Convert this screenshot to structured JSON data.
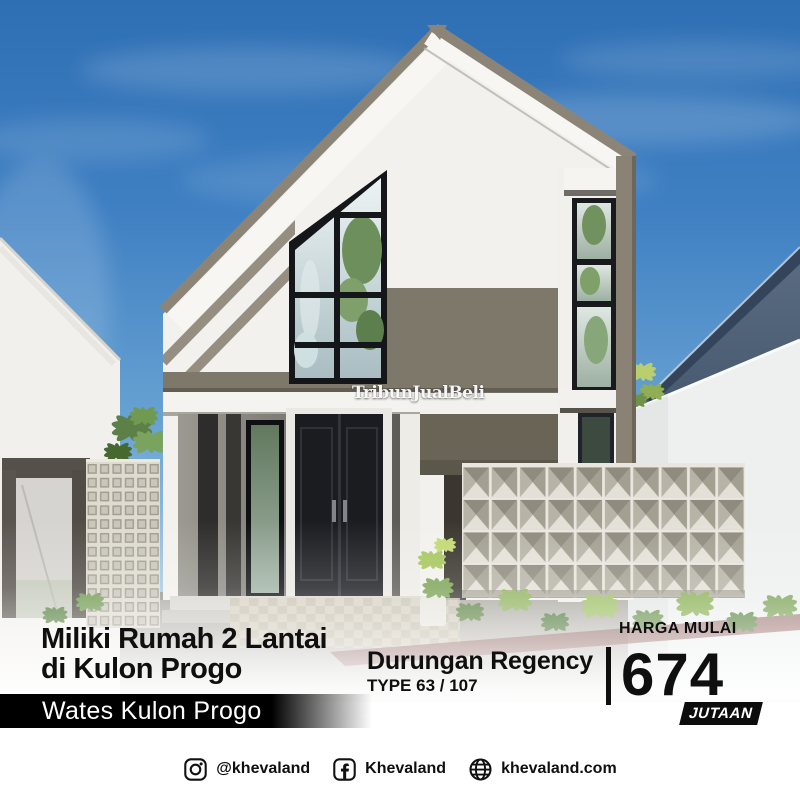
{
  "watermark": {
    "text": "TribunJualBeli"
  },
  "headline": {
    "line1": "Miliki Rumah 2 Lantai",
    "line2": "di Kulon Progo"
  },
  "location_banner": {
    "text": "Wates Kulon Progo"
  },
  "project": {
    "name": "Durungan Regency",
    "type": "TYPE 63 / 107"
  },
  "price": {
    "label": "HARGA MULAI",
    "value": "674",
    "unit": "JUTAAN"
  },
  "social": {
    "instagram_handle": "@khevaland",
    "facebook_handle": "Khevaland",
    "website": "khevaland.com"
  },
  "colors": {
    "headline_text": "#0f0f0f",
    "banner_bg": "#000000",
    "banner_text": "#ffffff",
    "price_text": "#0f0f0f",
    "badge_bg": "#0c0c0c",
    "badge_text": "#ffffff",
    "sky_blue": "#3578bb",
    "roof_taupe": "#8c8577",
    "wall_white": "#f2f1ed",
    "door_dark": "#1b1c20",
    "fence_white": "#eef0f0",
    "neighbor_roof": "#46586e",
    "foliage_green": "#7da457"
  }
}
